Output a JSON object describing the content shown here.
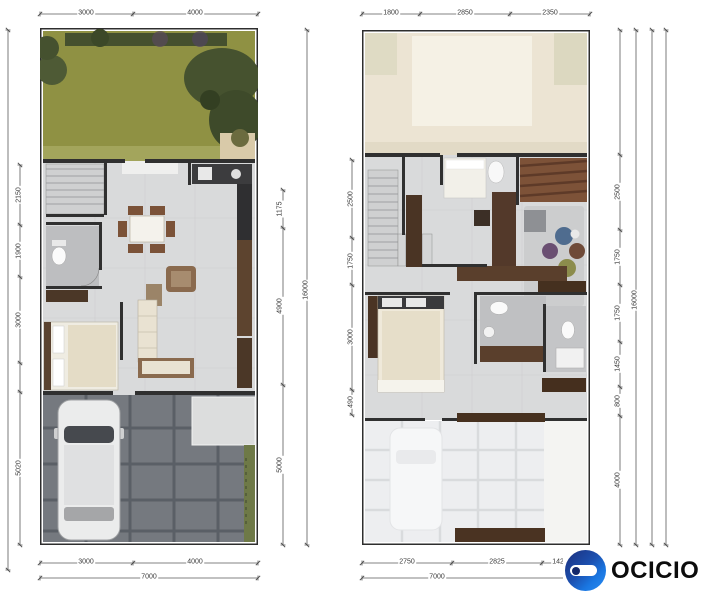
{
  "brand": {
    "name": "OCICIO",
    "icon": "ocicio-logo-icon",
    "colors": {
      "navy": "#1c3c8f",
      "blue": "#1678e8",
      "text": "#0c0c0c"
    }
  },
  "ground_floor": {
    "dims": {
      "top": [
        "3000",
        "4000"
      ],
      "bottom": [
        "3000",
        "4000"
      ],
      "bottom_total": "7000",
      "left": [
        "2150",
        "1900",
        "3000",
        "5020"
      ],
      "right": [
        "1175",
        "4900",
        "5000"
      ],
      "right_total": "16000"
    }
  },
  "upper_floor": {
    "dims": {
      "top": [
        "1800",
        "2850",
        "2350"
      ],
      "bottom": [
        "2750",
        "2825",
        "1425"
      ],
      "bottom_total": "7000",
      "left": [
        "2500",
        "1750",
        "3000",
        "490"
      ],
      "right": [
        "2500",
        "1750",
        "1750",
        "1450",
        "800",
        "4000"
      ],
      "right_total": "16000"
    }
  }
}
